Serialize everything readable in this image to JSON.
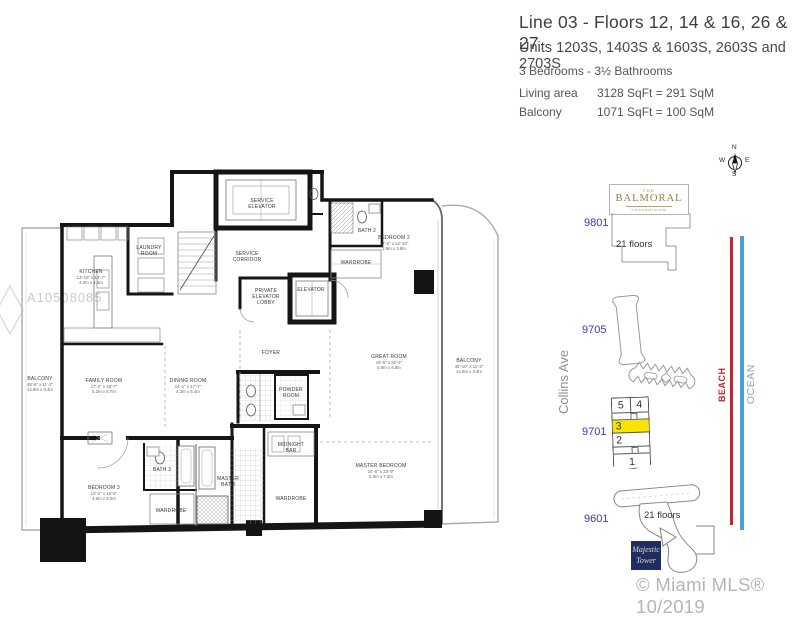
{
  "header": {
    "line1": "Line 03  -  Floors 12, 14 & 16, 26 & 27",
    "line2": "Units 1203S, 1403S & 1603S, 2603S and 2703S",
    "line3": "3  Bedrooms  -  3½  Bathrooms",
    "living_label": "Living area",
    "living_value": "3128  SqFt  =  291  SqM",
    "balcony_label": "Balcony",
    "balcony_value": "1071  SqFt  =  100  SqM"
  },
  "watermark": "A10508085",
  "floorplan": {
    "rooms": [
      {
        "id": "kitchen",
        "lines": [
          "KITCHEN",
          "13'-10\" x 14'-7\"",
          "4.2m x 4.4m"
        ]
      },
      {
        "id": "laundry",
        "lines": [
          "LAUNDRY",
          "ROOM"
        ]
      },
      {
        "id": "service-elevator",
        "lines": [
          "SERVICE",
          "ELEVATOR"
        ]
      },
      {
        "id": "service-corridor",
        "lines": [
          "SERVICE",
          "CORRIDOR"
        ]
      },
      {
        "id": "private-elevator-lobby",
        "lines": [
          "PRIVATE",
          "ELEVATOR",
          "LOBBY"
        ]
      },
      {
        "id": "elevator",
        "lines": [
          "ELEVATOR"
        ]
      },
      {
        "id": "bedroom-2",
        "lines": [
          "BEDROOM 2",
          "12'-5\" x 12'-10\"",
          "3.8m x 3.9m"
        ]
      },
      {
        "id": "bath-2",
        "lines": [
          "BATH 2"
        ]
      },
      {
        "id": "wardrobe-2",
        "lines": [
          "WARDROBE"
        ]
      },
      {
        "id": "family-room",
        "lines": [
          "FAMILY ROOM",
          "17'-2\" x 18'-7\"",
          "5.2m x 5.7m"
        ]
      },
      {
        "id": "dining-room",
        "lines": [
          "DINING ROOM",
          "14'-1\" x 17'-7\"",
          "4.3m x 5.4m"
        ]
      },
      {
        "id": "great-room",
        "lines": [
          "GREAT ROOM",
          "19'-6\" x 22'-4\"",
          "5.9m x 6.8m"
        ]
      },
      {
        "id": "balcony-right",
        "lines": [
          "BALCONY",
          "48'-10\" x 11'-2\"",
          "14.9m x 3.4m"
        ]
      },
      {
        "id": "balcony-left",
        "lines": [
          "BALCONY",
          "48'-6\" x 11'-2\"",
          "14.8m x 3.4m"
        ]
      },
      {
        "id": "foyer",
        "lines": [
          "FOYER"
        ]
      },
      {
        "id": "powder-room",
        "lines": [
          "POWDER",
          "ROOM"
        ]
      },
      {
        "id": "midnight-bar",
        "lines": [
          "MIDNIGHT",
          "BAR"
        ]
      },
      {
        "id": "master-bedroom",
        "lines": [
          "MASTER BEDROOM",
          "16'-5\" x 23'-9\"",
          "5.0m x 7.2m"
        ]
      },
      {
        "id": "wardrobe-master",
        "lines": [
          "WARDROBE"
        ]
      },
      {
        "id": "master-bath",
        "lines": [
          "MASTER",
          "BATH"
        ]
      },
      {
        "id": "bedroom-3",
        "lines": [
          "BEDROOM 3",
          "13'-2\" x 16'-6\"",
          "4.0m x 5.0m"
        ]
      },
      {
        "id": "bath-3",
        "lines": [
          "BATH 3"
        ]
      },
      {
        "id": "wardrobe-3",
        "lines": [
          "WARDROBE"
        ]
      }
    ]
  },
  "sitemap": {
    "compass": {
      "n": "N",
      "e": "E",
      "s": "S",
      "w": "W"
    },
    "balmoral": {
      "the": "THE",
      "name": "BALMORAL",
      "sub": "CONDOMINIUM",
      "floors": "21 floors",
      "address": "9801"
    },
    "addresses": {
      "a9705": "9705",
      "a9701": "9701",
      "a9601": "9601"
    },
    "street": "Collins Ave",
    "beach": "BEACH",
    "ocean": "OCEAN",
    "stack_units": [
      "5",
      "4",
      "3",
      "2",
      "1"
    ],
    "highlighted_unit": "3",
    "majestic": {
      "floors": "21 floors",
      "logo_line1": "Majestic",
      "logo_line2": "Tower"
    },
    "copyright": "© Miami MLS® 10/2019",
    "colors": {
      "highlight": "#f8e400",
      "beach_line": "#c1272d",
      "ocean_line": "#4a9fd4",
      "address_blue": "#3a3ab8"
    }
  }
}
